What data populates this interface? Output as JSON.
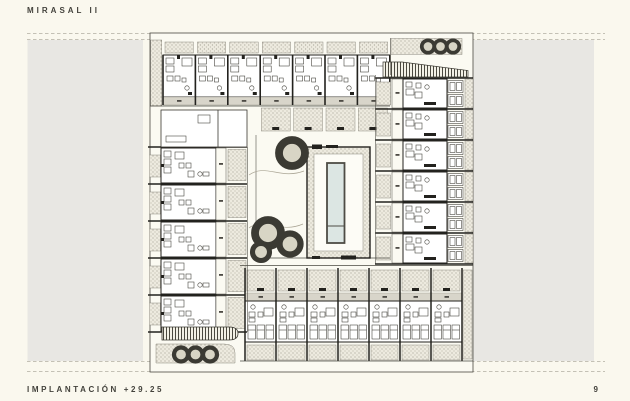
{
  "header": {
    "title": "MIRASAL II"
  },
  "footer": {
    "caption": "IMPLANTACIÓN +29.25",
    "page_number": "9"
  },
  "colors": {
    "page_bg": "#faf8ee",
    "street_gray": "#e8e7e3",
    "plan_bg": "#fbfaf2",
    "line_dark": "#23221e",
    "pool_blue": "#dce6e3",
    "label_band": "#d8d5ca"
  },
  "plan": {
    "top_row_units": 7,
    "left_column_units": 5,
    "right_column_units": 6,
    "bottom_row_units": 7
  }
}
